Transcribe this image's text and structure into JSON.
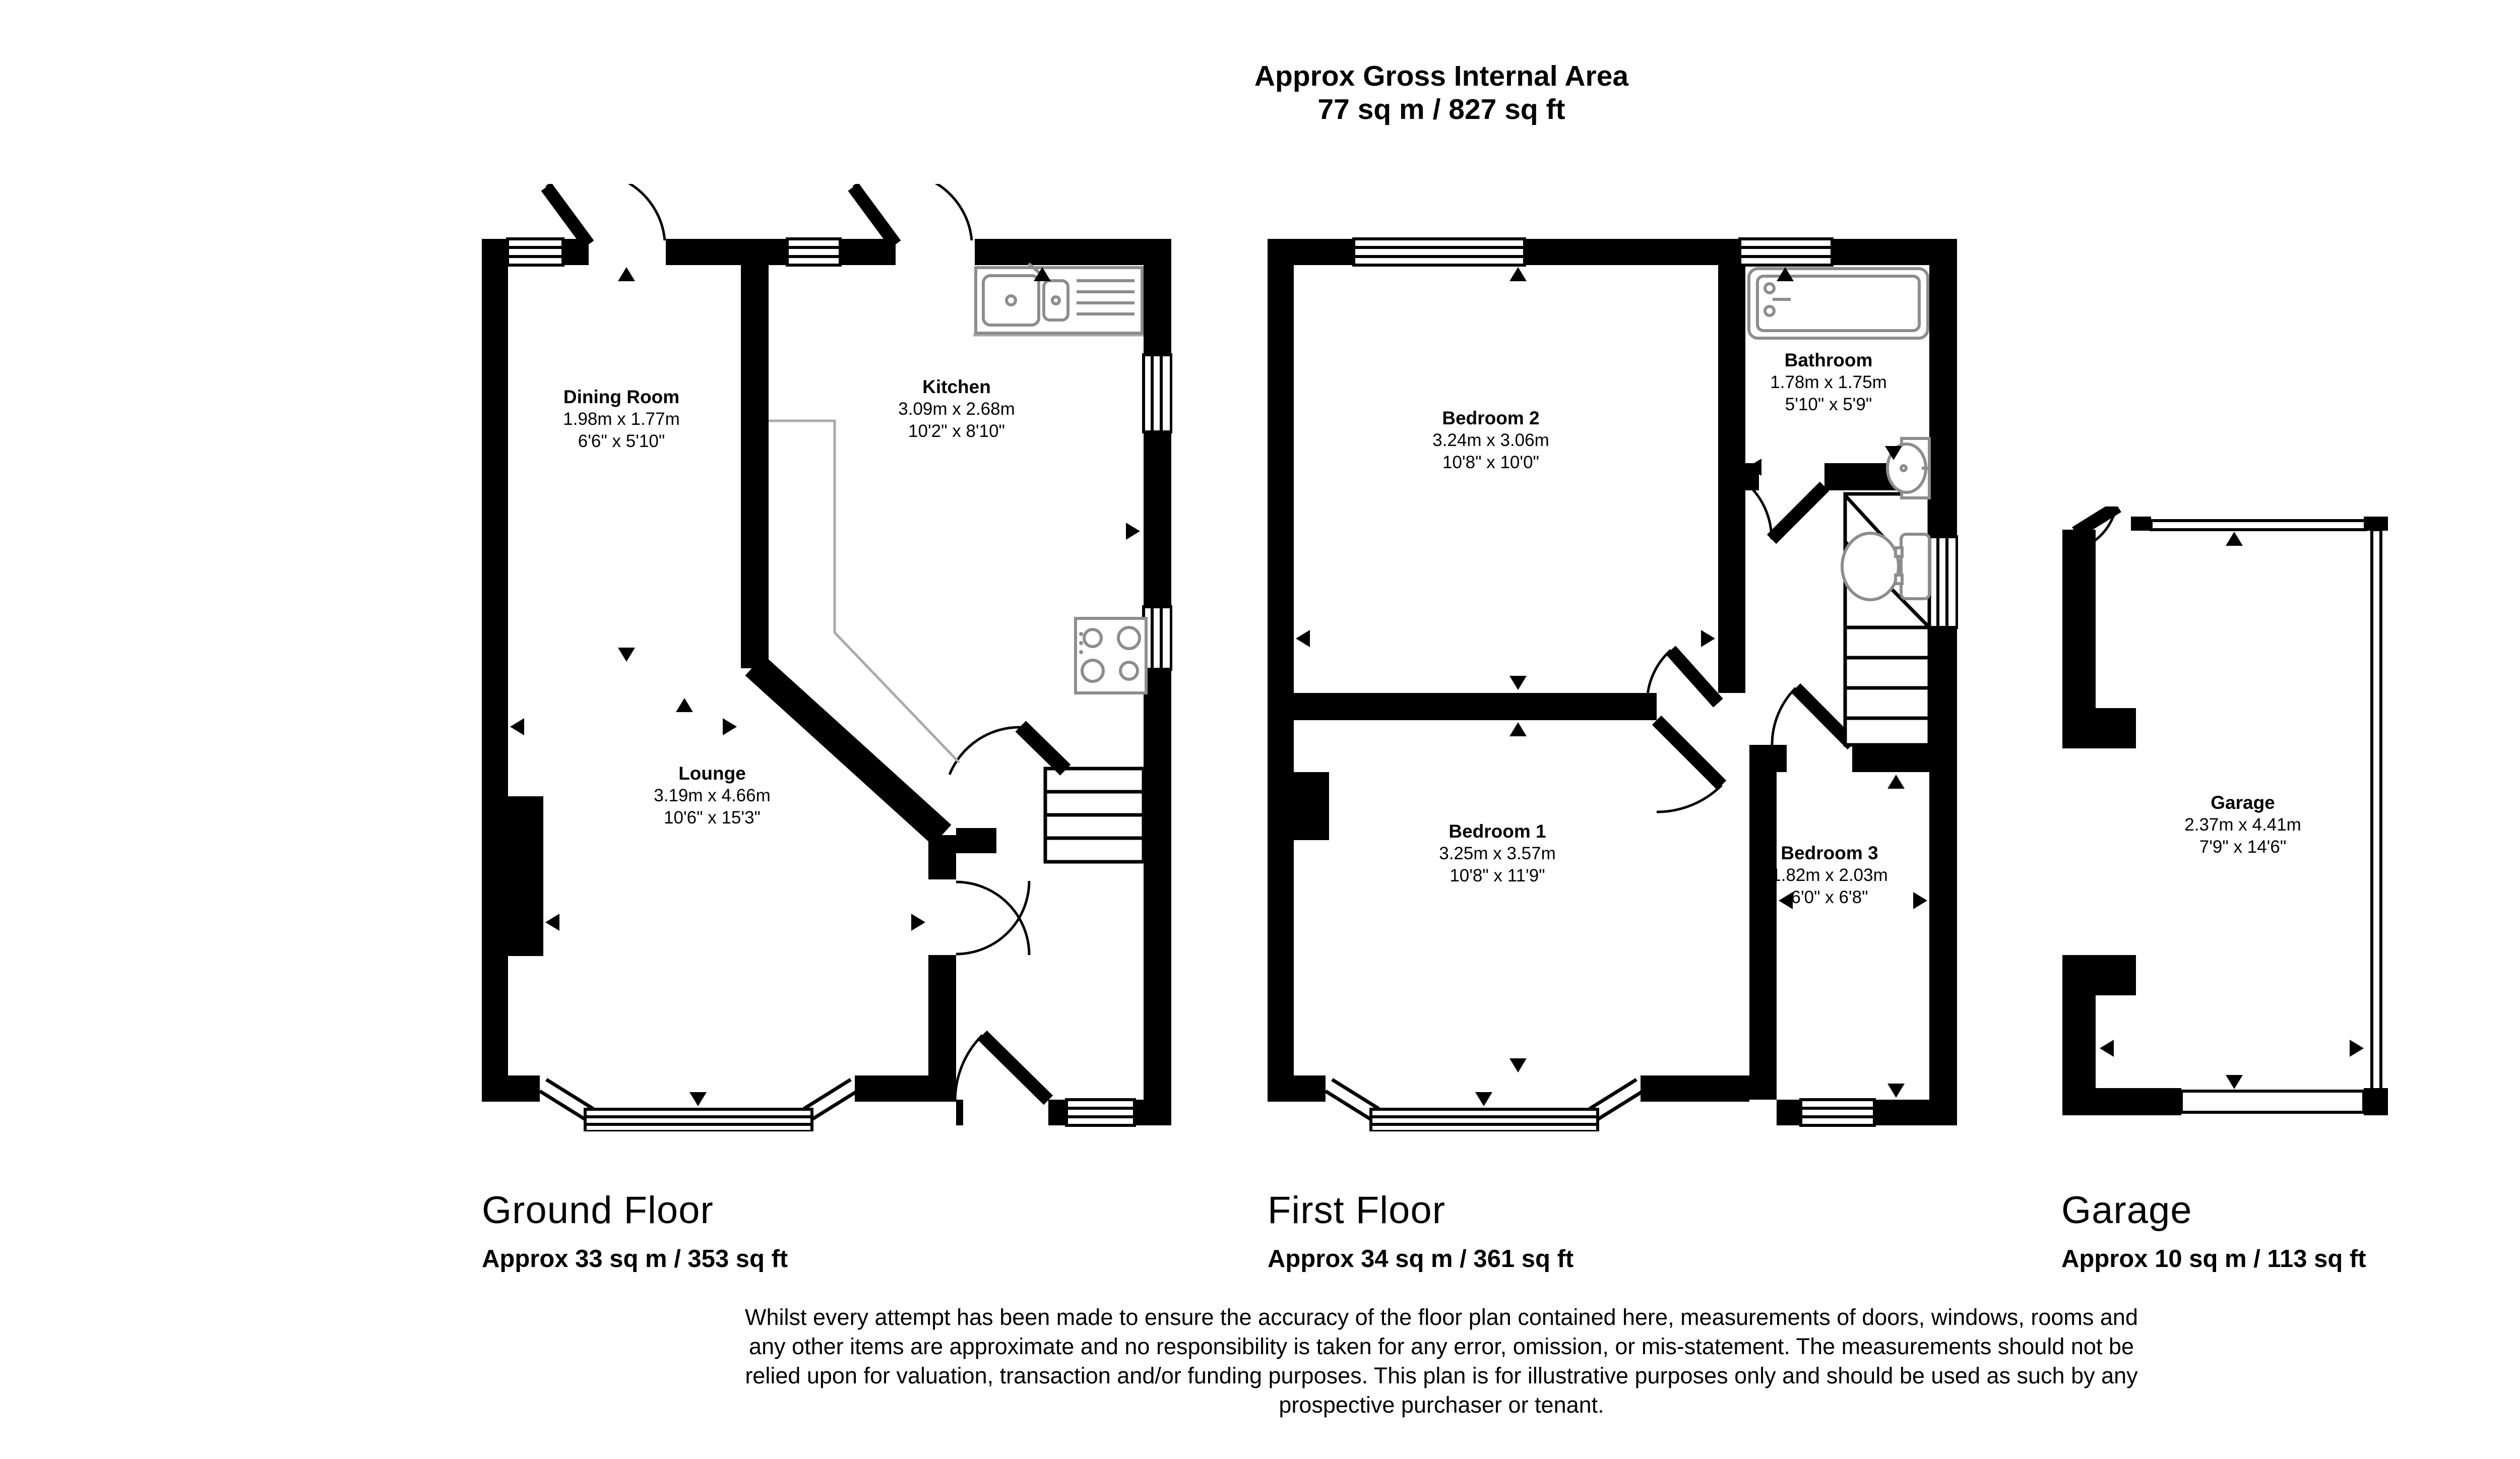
{
  "header": {
    "title": "Approx Gross Internal Area",
    "subtitle": "77 sq m / 827 sq ft"
  },
  "compass": {
    "north": "N",
    "east": "E",
    "south": "S",
    "west": "W"
  },
  "floors": [
    {
      "name": "Ground Floor",
      "area": "Approx 33 sq m / 353 sq ft",
      "rooms": [
        {
          "name": "Dining Room",
          "metric": "1.98m x 1.77m",
          "imperial": "6'6\" x 5'10\""
        },
        {
          "name": "Kitchen",
          "metric": "3.09m x 2.68m",
          "imperial": "10'2\" x 8'10\""
        },
        {
          "name": "Lounge",
          "metric": "3.19m x 4.66m",
          "imperial": "10'6\" x 15'3\""
        }
      ]
    },
    {
      "name": "First Floor",
      "area": "Approx 34 sq m / 361 sq ft",
      "rooms": [
        {
          "name": "Bedroom 2",
          "metric": "3.24m x 3.06m",
          "imperial": "10'8\" x 10'0\""
        },
        {
          "name": "Bathroom",
          "metric": "1.78m x 1.75m",
          "imperial": "5'10\" x 5'9\""
        },
        {
          "name": "Bedroom 1",
          "metric": "3.25m x 3.57m",
          "imperial": "10'8\" x 11'9\""
        },
        {
          "name": "Bedroom 3",
          "metric": "1.82m x 2.03m",
          "imperial": "6'0\" x 6'8\""
        }
      ]
    },
    {
      "name": "Garage",
      "area": "Approx 10 sq m / 113 sq ft",
      "rooms": [
        {
          "name": "Garage",
          "metric": "2.37m x 4.41m",
          "imperial": "7'9\" x 14'6\""
        }
      ]
    }
  ],
  "disclaimer": {
    "lines": [
      "Whilst every attempt has been made to ensure the accuracy of the floor plan contained here, measurements of doors, windows, rooms and",
      "any other items are approximate and no responsibility is taken for any error, omission, or mis-statement. The measurements should not be",
      "relied upon for valuation, transaction and/or funding purposes. This plan is for illustrative purposes only and should be used as such by any",
      "prospective purchaser or tenant."
    ]
  },
  "colors": {
    "wall": "#000000",
    "fixture": "#8d8d8d",
    "compass": "#3b3b3d"
  }
}
